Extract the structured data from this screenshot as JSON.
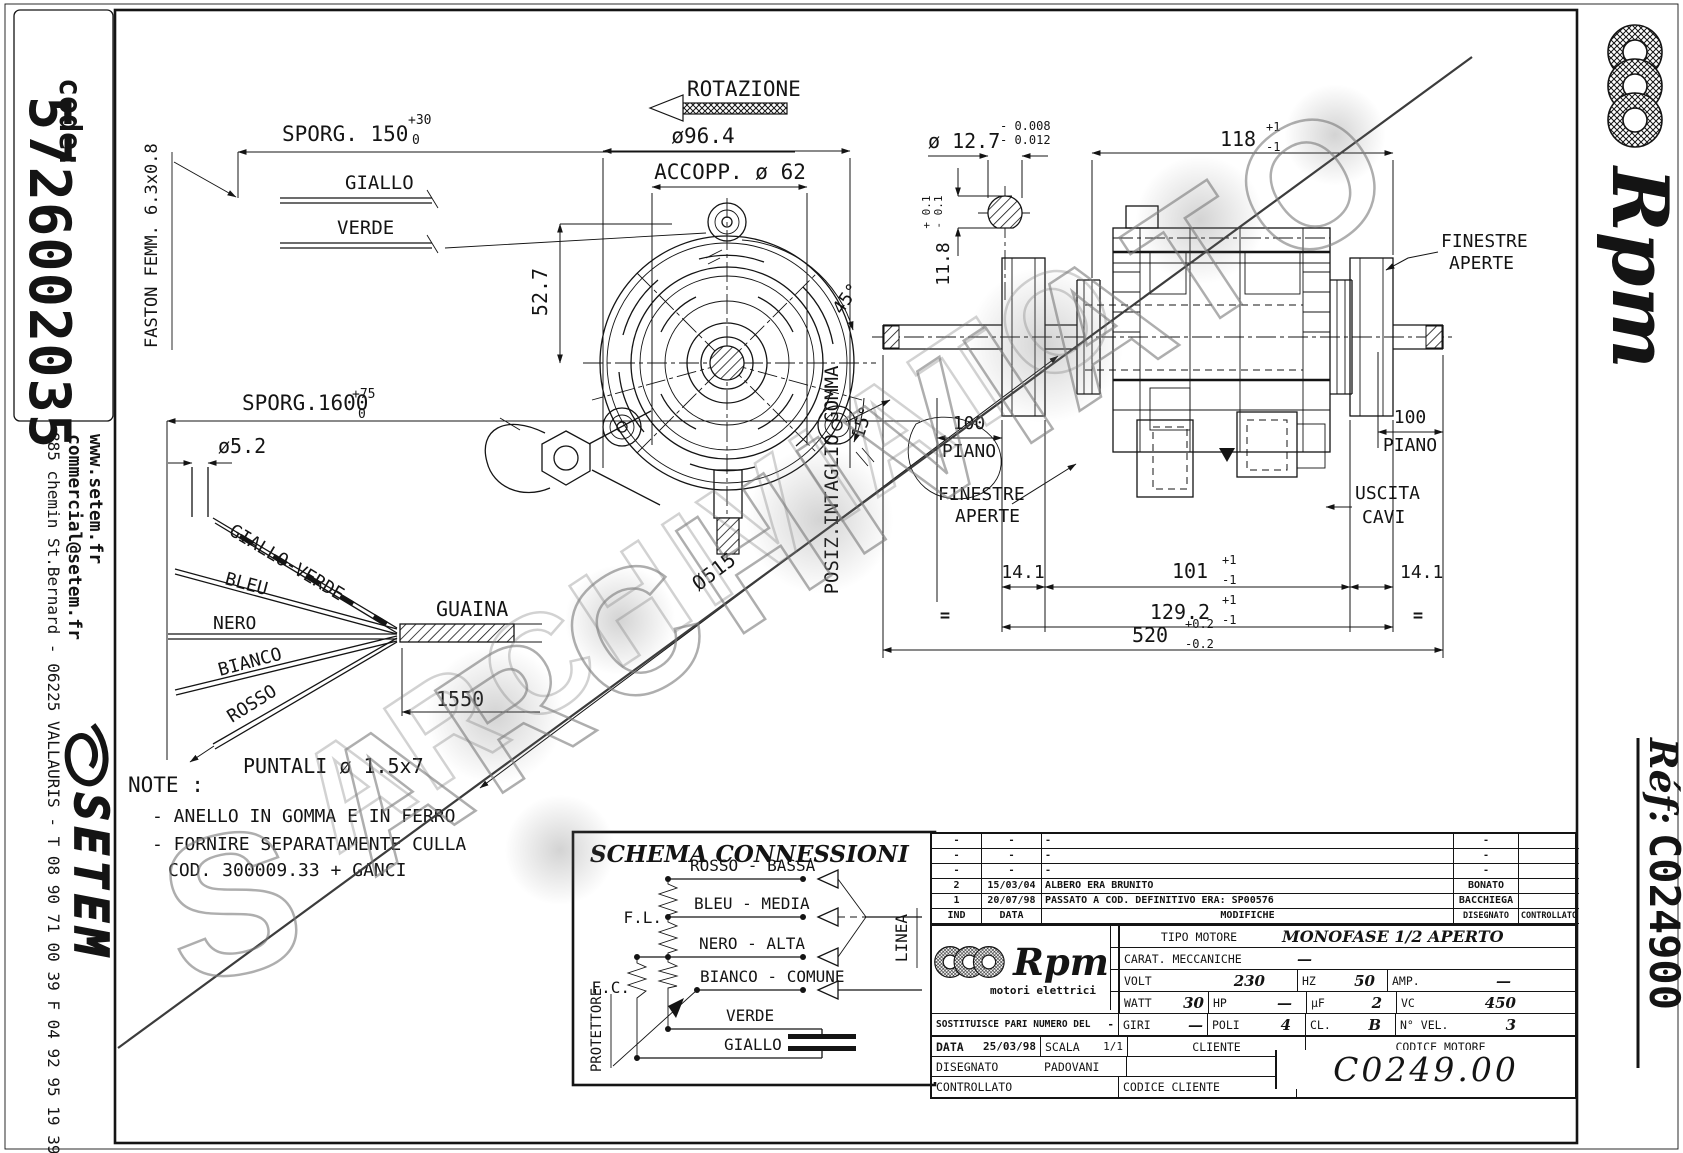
{
  "watermark": {
    "text": "ARCHIVIATO",
    "s": "S"
  },
  "left_bar": {
    "code_label": "code:",
    "code_value": "5726002035",
    "website": "www.setem.fr",
    "email": "commercial@setem.fr",
    "address": "885 chemin St.Bernard  -  06225 VALLAURIS  -  T 08 90 71 00 39  F 04 92 95 19 39",
    "logo": "SETEM"
  },
  "right_bar": {
    "brand": "Rpm",
    "ref_label": "Réf:",
    "ref_value": "C024900"
  },
  "wiring": {
    "faston": "FASTON FEMM. 6.3x0.8",
    "sporg150": "SPORG. 150",
    "sporg150_up": "+30",
    "sporg150_dn": "0",
    "giallo": "GIALLO",
    "verde": "VERDE",
    "sporg1600": "SPORG.1600",
    "sporg1600_up": "+75",
    "sporg1600_dn": "0",
    "dia": "ø5.2",
    "w1": "GIALLO-VERDE",
    "w2": "BLEU",
    "w3": "NERO",
    "w4": "BIANCO",
    "w5": "ROSSO",
    "guaina": "GUAINA",
    "len": "1550",
    "puntali": "PUNTALI ø 1.5x7"
  },
  "note": {
    "title": "NOTE :",
    "l1": "- ANELLO IN GOMMA E IN FERRO",
    "l2": "- FORNIRE SEPARATAMENTE CULLA",
    "l3": "COD. 300009.33 + GANCI"
  },
  "front": {
    "rotazione": "ROTAZIONE",
    "d964": "ø96.4",
    "accopp": "ACCOPP. ø 62",
    "d527": "52.7",
    "a45": "45°",
    "a15": "15°",
    "diag": "Ø515",
    "gomma": "POSIZ.INTAGLIO GOMMA"
  },
  "section": {
    "dia": "ø 12.7",
    "du": "- 0.008",
    "dd": "- 0.012",
    "flat": "11.8",
    "fu": "+ 0.1",
    "fd": "- 0.1"
  },
  "side": {
    "d118": "118",
    "p1": "+1",
    "m1": "-1",
    "fin1": "FINESTRE",
    "fin2": "APERTE",
    "d100": "100",
    "piano": "PIANO",
    "usc1": "USCITA",
    "usc2": "CAVI",
    "d141": "14.1",
    "d101": "101",
    "d1292": "129.2",
    "d520": "520",
    "p02": "+0.2",
    "m02": "-0.2",
    "eq": "="
  },
  "schema": {
    "title": "SCHEMA CONNESSIONI",
    "r1": "ROSSO - BASSA",
    "r2": "BLEU - MEDIA",
    "r3": "NERO - ALTA",
    "r4": "BIANCO - COMUNE",
    "r5": "VERDE",
    "r6": "GIALLO",
    "fl": "F.L.",
    "fc": "F.C.",
    "prot": "PROTETTORE",
    "linea": "LINEA"
  },
  "tb": {
    "rev": [
      {
        "ind": "-",
        "date": "-",
        "mod": "-",
        "dis": "-",
        "ctl": ""
      },
      {
        "ind": "-",
        "date": "-",
        "mod": "-",
        "dis": "-",
        "ctl": ""
      },
      {
        "ind": "-",
        "date": "-",
        "mod": "-",
        "dis": "-",
        "ctl": ""
      },
      {
        "ind": "2",
        "date": "15/03/04",
        "mod": "ALBERO ERA BRUNITO",
        "dis": "BONATO",
        "ctl": ""
      },
      {
        "ind": "1",
        "date": "20/07/98",
        "mod": "PASSATO A COD. DEFINITIVO ERA: SP00576",
        "dis": "BACCHIEGA",
        "ctl": ""
      }
    ],
    "h_ind": "IND",
    "h_data": "DATA",
    "h_mod": "MODIFICHE",
    "h_dis": "DISEGNATO",
    "h_ctl": "CONTROLLATO",
    "brand": "Rpm",
    "brand_sub": "motori elettrici",
    "tipo_l": "TIPO MOTORE",
    "tipo_v": "MONOFASE 1/2 APERTO",
    "carat_l": "CARAT. MECCANICHE",
    "carat_v": "—",
    "volt_l": "VOLT",
    "volt_v": "230",
    "hz_l": "HZ",
    "hz_v": "50",
    "amp_l": "AMP.",
    "amp_v": "—",
    "watt_l": "WATT",
    "watt_v": "30",
    "hp_l": "HP",
    "hp_v": "—",
    "uf_l": "µF",
    "uf_v": "2",
    "vc_l": "VC",
    "vc_v": "450",
    "sost_l": "SOSTITUISCE PARI NUMERO DEL",
    "sost_v": "-",
    "giri_l": "GIRI",
    "giri_v": "—",
    "poli_l": "POLI",
    "poli_v": "4",
    "cl_l": "CL.",
    "cl_v": "B",
    "nvel_l": "N° VEL.",
    "nvel_v": "3",
    "data_l": "DATA",
    "data_v": "25/03/98",
    "scala_l": "SCALA",
    "scala_v": "1/1",
    "cliente_l": "CLIENTE",
    "codmot_l": "CODICE MOTORE",
    "dis_l": "DISEGNATO",
    "dis_v": "PADOVANI",
    "ctl_l": "CONTROLLATO",
    "codcli_l": "CODICE CLIENTE",
    "code": "C0249.00"
  }
}
